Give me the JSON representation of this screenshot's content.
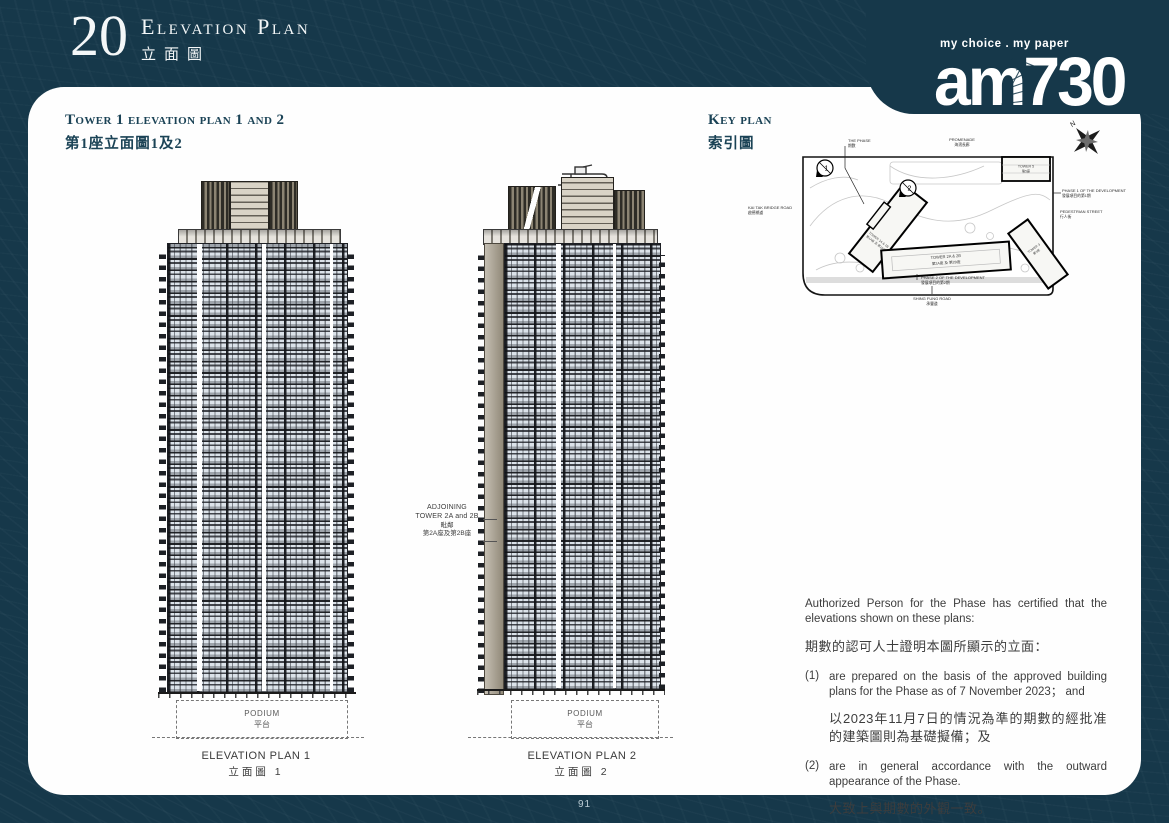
{
  "colors": {
    "page_bg": "#16384a",
    "card_bg": "#fefefe",
    "heading": "#1b4356",
    "body_text": "#3d3d3d",
    "window_tint": "#dbe2e9",
    "adjoining_tower": "#a59c89"
  },
  "header": {
    "number": "20",
    "title_en": "Elevation Plan",
    "title_zh": "立面圖"
  },
  "logo": {
    "tagline": "my choice . my paper",
    "name": "am730"
  },
  "left_panel": {
    "title_en": "Tower 1 elevation plan 1 and 2",
    "title_zh": "第1座立面圖1及2"
  },
  "key_plan": {
    "title_en": "Key plan",
    "title_zh": "索引圖",
    "north": "N",
    "labels": {
      "the_phase_en": "THE PHASE",
      "the_phase_zh": "期數",
      "promenade_en": "PROMENADE",
      "promenade_zh": "海濱長廊",
      "kai_tak_en": "KAI TAK BRIDGE ROAD",
      "kai_tak_zh": "啟德橋道",
      "phase1_en": "PHASE 1 OF THE DEVELOPMENT",
      "phase1_zh": "發展項目的第1期",
      "pedestrian_en": "PEDESTRIAN STREET",
      "pedestrian_zh": "行人街",
      "phase2_en": "PHASE 2 OF THE DEVELOPMENT",
      "phase2_zh": "發展項目的第2期",
      "shing_fung_en": "SHING FUNG ROAD",
      "shing_fung_zh": "承豐道",
      "tower1_en": "TOWER 1A & 1B",
      "tower1_zh": "第1A座 及 第1B座",
      "tower2_en": "TOWER 2A & 2B",
      "tower2_zh": "第2A座 及 第2B座",
      "tower3_en": "TOWER 3",
      "tower3_zh": "第3座",
      "tower5_en": "TOWER 5",
      "tower5_zh": "第5座",
      "marker1": "1",
      "marker2": "2"
    }
  },
  "elevation1": {
    "podium_en": "PODIUM",
    "podium_zh": "平台",
    "caption_en": "ELEVATION PLAN 1",
    "caption_zh": "立面圖 1"
  },
  "elevation2": {
    "podium_en": "PODIUM",
    "podium_zh": "平台",
    "caption_en": "ELEVATION PLAN 2",
    "caption_zh": "立面圖 2"
  },
  "adjoining": {
    "line1": "ADJOINING",
    "line2": "TOWER 2A and 2B",
    "line3": "毗鄰",
    "line4": "第2A座及第2B座"
  },
  "certification": {
    "intro_en": "Authorized Person for the Phase has certified that the elevations shown on these plans:",
    "intro_zh": "期數的認可人士證明本圖所顯示的立面：",
    "item1_no": "(1)",
    "item1_en": "are prepared on the basis of the approved building plans for the Phase as of 7 November 2023； and",
    "item1_zh": "以2023年11月7日的情況為準的期數的經批准的建築圖則為基礎擬備；及",
    "item2_no": "(2)",
    "item2_en": "are in general accordance with the outward appearance of the Phase.",
    "item2_zh": "大致上與期數的外觀一致。"
  },
  "footer": {
    "page_number": "91"
  }
}
